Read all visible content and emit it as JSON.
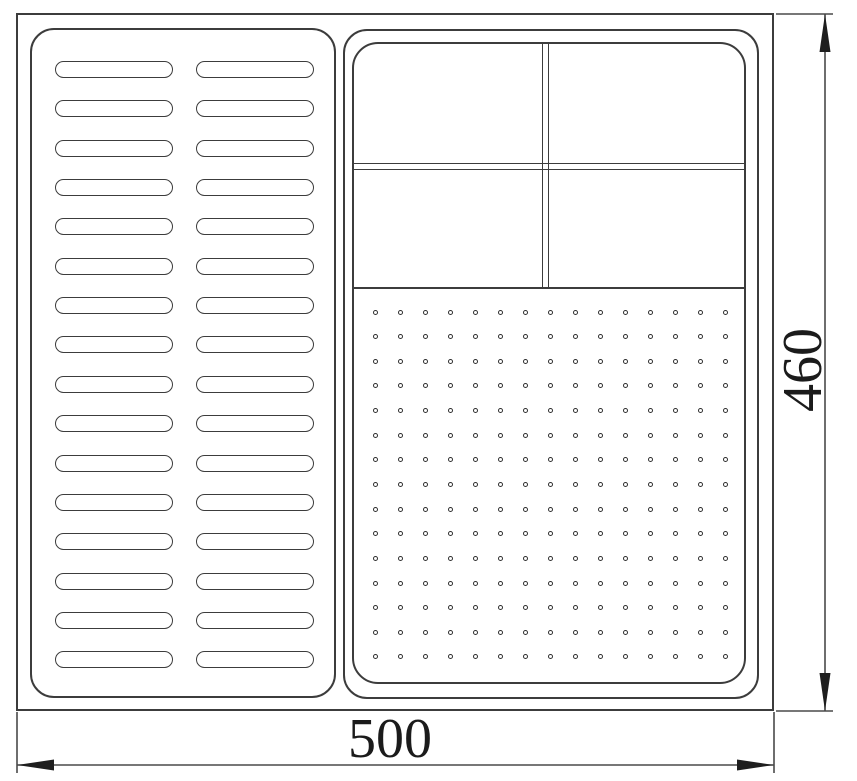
{
  "drawing": {
    "type": "technical-drawing-top-view",
    "dimensions": {
      "width": {
        "value": "500"
      },
      "height": {
        "value": "460"
      }
    },
    "left_panel": {
      "description": "slotted rack area",
      "slot_rows": 16,
      "slot_columns": 2
    },
    "right_panel": {
      "description": "compartment tray area",
      "compartment_rows": 2,
      "compartment_columns": 2,
      "perforation_rows": 15,
      "perforation_columns": 15
    },
    "colors": {
      "line": "#3c3c3c",
      "dimension_line": "#4a4a4a",
      "arrow": "#1e1e1e",
      "text": "#1b1b1b",
      "background": "#ffffff"
    }
  }
}
